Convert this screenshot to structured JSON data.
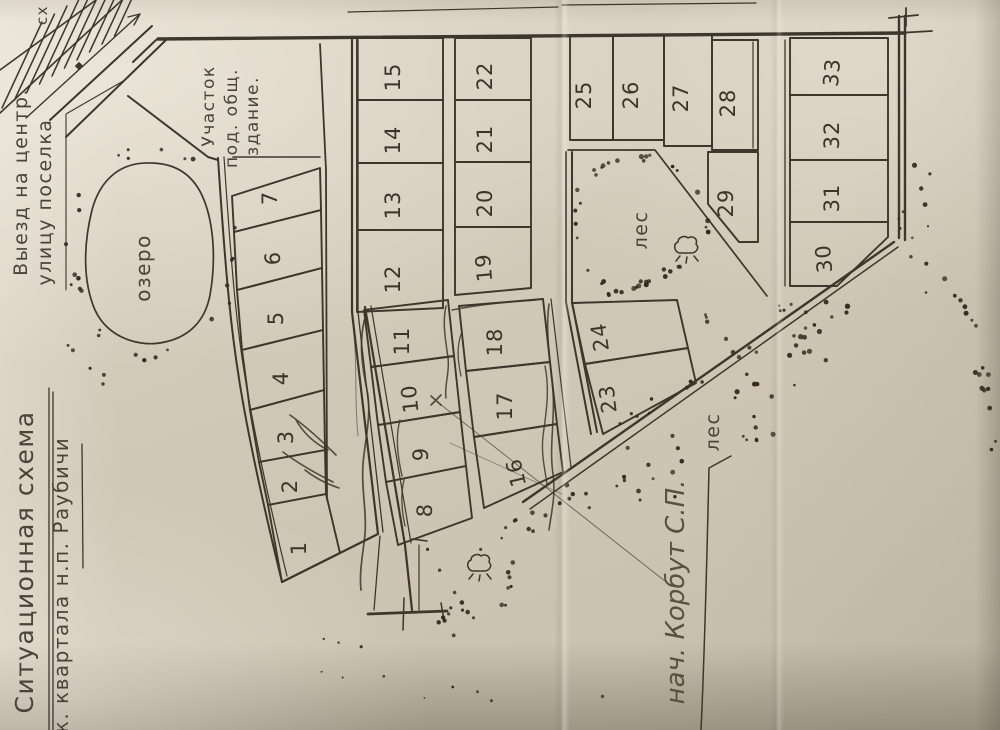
{
  "title": {
    "line1": "Ситуационная схема",
    "line2": "ж. квартала н.п. Раубичи"
  },
  "annotations": {
    "exit_road": {
      "line1": "Выезд на центр.",
      "line2": "улицу поселка"
    },
    "public_building_plot": {
      "line1": "Участок",
      "line2": "под. общ.",
      "line3": "здание."
    },
    "lake": "озеро",
    "forest_upper": "лес",
    "forest_lower": "лес",
    "signature": "нач. Корбут С.П.",
    "edge_fragment": "сх"
  },
  "plots": [
    "1",
    "2",
    "3",
    "4",
    "5",
    "6",
    "7",
    "8",
    "9",
    "10",
    "11",
    "12",
    "13",
    "14",
    "15",
    "16",
    "17",
    "18",
    "19",
    "20",
    "21",
    "22",
    "23",
    "24",
    "25",
    "26",
    "27",
    "28",
    "29",
    "30",
    "31",
    "32",
    "33"
  ],
  "highlighted_plot": "10",
  "colors": {
    "paper": "#d4cbbc",
    "ink": "#3c372c",
    "pen_blue": "#6b74bd",
    "pencil": "#6c665a"
  }
}
